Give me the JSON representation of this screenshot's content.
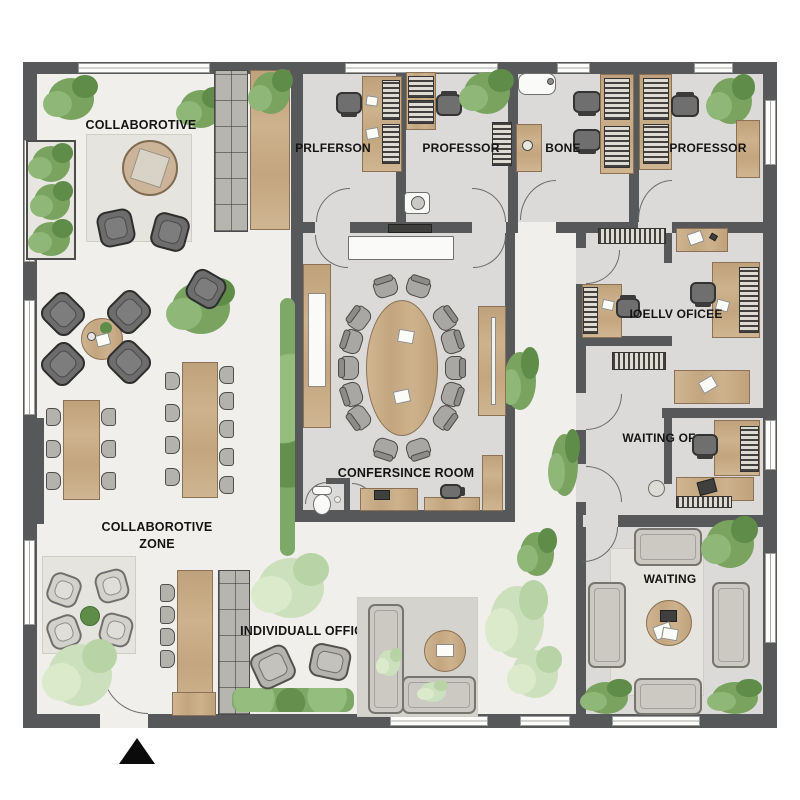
{
  "plan": {
    "title": "office floor plan",
    "labels": {
      "collaborotive": "COLLABOROTIVE",
      "prlferson": "PRLFERSON",
      "professor_top_left": "PROFESSOR",
      "bone": "BONE",
      "professor_top_right": "PROFESSOR",
      "ioellv_oficee": "IOELLV OFICEE",
      "waiting_of": "WAITING OF",
      "confersince_room": "CONFERSINCE ROOM",
      "collaborotive_zone_line1": "COLLABOROTIVE",
      "collaborotive_zone_line2": "ZONE",
      "individuall_office": "INDIVIDUALL OFFICE",
      "waiting": "WAITING"
    },
    "colors": {
      "wall": "#57585a",
      "floor": "#f0efeb",
      "room": "#dbdad8",
      "rug": "#e6e4de",
      "wood": "#c9ad8a",
      "wood_dark": "#8b7254",
      "plant": "#79a35f",
      "plant_light": "#cde0bd",
      "chair_dark": "#6d6d6d",
      "chair_light": "#ccc9c3"
    }
  }
}
